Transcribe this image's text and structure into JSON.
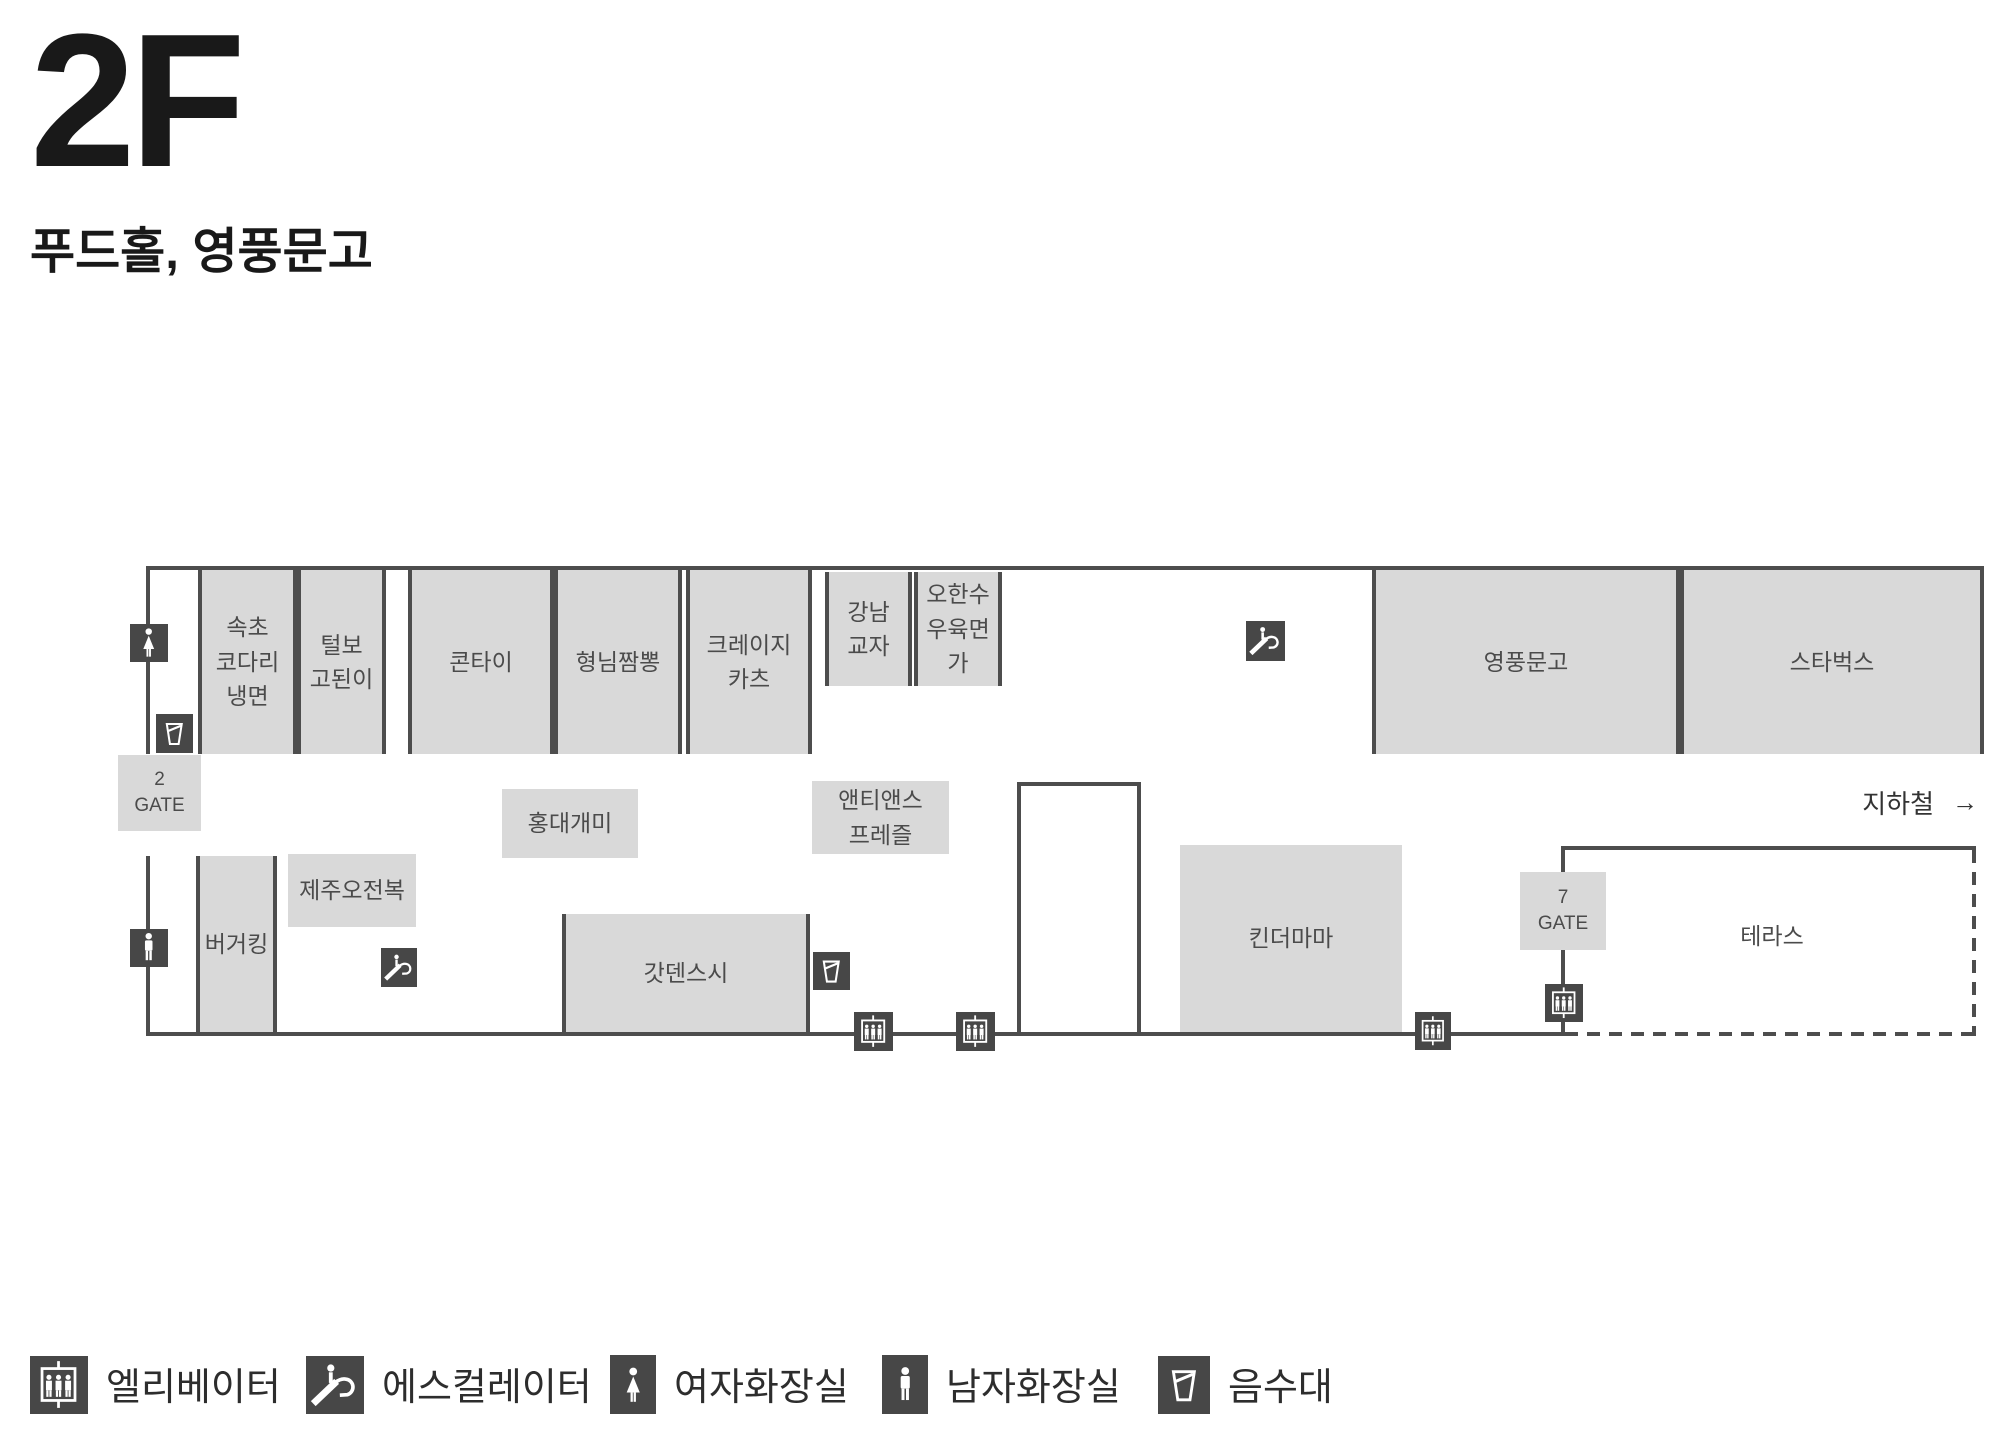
{
  "header": {
    "floor": "2F",
    "subtitle": "푸드홀, 영풍문고"
  },
  "map": {
    "gate2": "2\nGATE",
    "gate7": "7\nGATE",
    "subway_label": "지하철",
    "subway_arrow": "→",
    "stores": [
      {
        "id": "sokcho-kodari-naengmyeon",
        "label": "속초\n코다리\n냉면"
      },
      {
        "id": "teolbo-godoeni",
        "label": "털보\n고된이"
      },
      {
        "id": "kontai",
        "label": "콘타이"
      },
      {
        "id": "hyungnim-jjamppong",
        "label": "형님짬뽕"
      },
      {
        "id": "crazy-katsu",
        "label": "크레이지\n카츠"
      },
      {
        "id": "gangnam-gyoja",
        "label": "강남\n교자"
      },
      {
        "id": "ohansu-wooyukmyeonga",
        "label": "오한수\n우육면가"
      },
      {
        "id": "youngpoong-bookstore",
        "label": "영풍문고"
      },
      {
        "id": "starbucks",
        "label": "스타벅스"
      },
      {
        "id": "hongdae-gaemi",
        "label": "홍대개미"
      },
      {
        "id": "auntie-annes-pretzel",
        "label": "앤티앤스\n프레즐"
      },
      {
        "id": "jeju-ojeonbok",
        "label": "제주오전복"
      },
      {
        "id": "burger-king",
        "label": "버거킹"
      },
      {
        "id": "gatten-sushi",
        "label": "갓덴스시"
      },
      {
        "id": "kinder-mama",
        "label": "킨더마마"
      },
      {
        "id": "terrace",
        "label": "테라스"
      }
    ]
  },
  "legend": {
    "items": [
      {
        "icon": "elevator-icon",
        "label": "엘리베이터"
      },
      {
        "icon": "escalator-icon",
        "label": "에스컬레이터"
      },
      {
        "icon": "female-restroom-icon",
        "label": "여자화장실"
      },
      {
        "icon": "male-restroom-icon",
        "label": "남자화장실"
      },
      {
        "icon": "water-fountain-icon",
        "label": "음수대"
      }
    ]
  },
  "colors": {
    "box_fill": "#d9d9d9",
    "wall": "#4d4d4d",
    "icon_bg": "#474747",
    "label_text": "#4b4b4b"
  }
}
